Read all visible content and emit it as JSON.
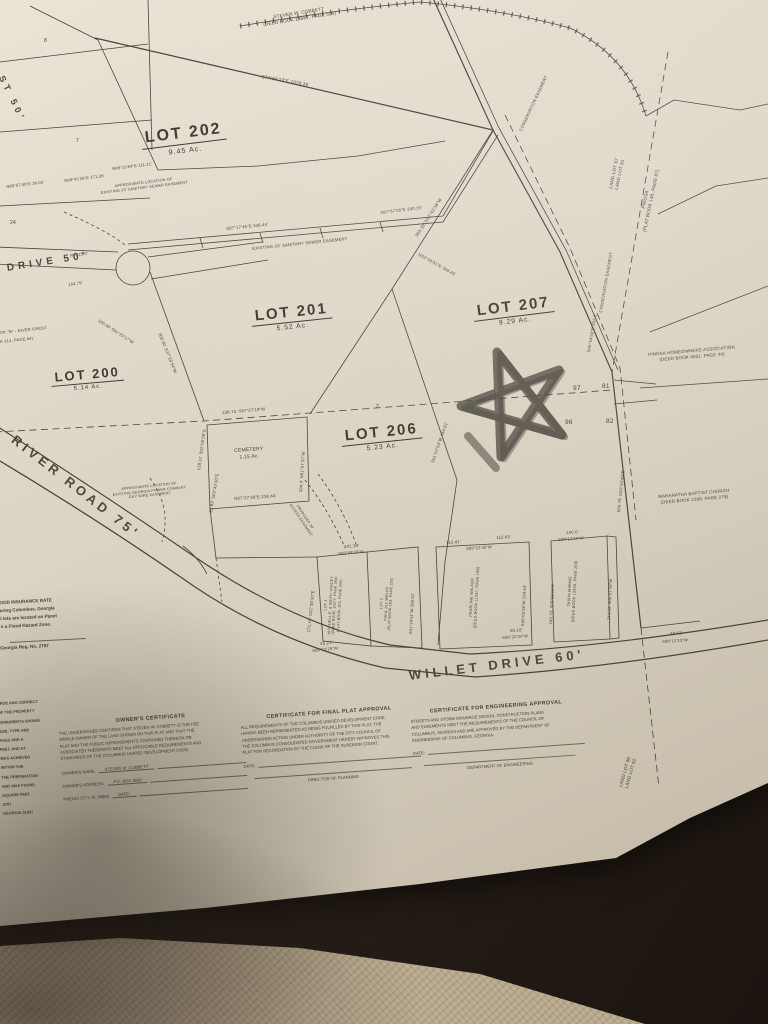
{
  "colors": {
    "paper": "#ded7c8",
    "ink": "#49443c",
    "marker_red": "#c02317",
    "background": "#2a211a",
    "carpet": "#b7a88c"
  },
  "map": {
    "lot_titles": [
      {
        "name": "LOT 202",
        "area": "9.45 Ac.",
        "x": 140,
        "y": 130,
        "r": -7,
        "s": 16
      },
      {
        "name": "LOT 201",
        "area": "5.52 Ac.",
        "x": 250,
        "y": 308,
        "r": -6,
        "s": 15
      },
      {
        "name": "LOT 207",
        "area": "9.29 Ac.",
        "x": 472,
        "y": 303,
        "r": -7,
        "s": 15
      },
      {
        "name": "LOT 200",
        "area": "5.14 Ac.",
        "x": 50,
        "y": 370,
        "r": -5,
        "s": 13
      },
      {
        "name": "LOT 206",
        "area": "5.23 Ac.",
        "x": 340,
        "y": 428,
        "r": -6,
        "s": 15
      }
    ],
    "labels": [
      {
        "t": "STEVEN W. COBBETT\n(DEED BOOK 13867, PAGE 500)",
        "x": 262,
        "y": 16,
        "r": -9,
        "s": 4.6,
        "c": "c"
      },
      {
        "t": "S74°54'13\"E   1078.36'",
        "x": 262,
        "y": 74,
        "r": 10,
        "s": 4.6
      },
      {
        "t": "365.36'  S32°42'38\"W",
        "x": 414,
        "y": 235,
        "r": -57,
        "s": 4.4
      },
      {
        "t": "CONSERVATION EASEMENT",
        "x": 518,
        "y": 130,
        "r": -65,
        "s": 4.2
      },
      {
        "t": "CONSERVATION EASEMENT",
        "x": 598,
        "y": 312,
        "r": -80,
        "s": 4.2
      },
      {
        "t": "LAND LOT 97\nLAND LOT 81",
        "x": 608,
        "y": 188,
        "r": -78,
        "s": 4.6,
        "c": "c"
      },
      {
        "t": "PINOSA\n(PLAT BOOK 148, PAGE 87)",
        "x": 636,
        "y": 230,
        "r": -78,
        "s": 4.6,
        "c": "c"
      },
      {
        "t": "PINOSA HOMEOWNERS ASSOCIATION\n(DEED BOOK 6051, PAGE 44)",
        "x": 648,
        "y": 352,
        "r": -5,
        "s": 4.4,
        "c": "c"
      },
      {
        "t": "MARANATHA BAPTIST CHURCH\n(DEED BOOK 2368, PAGE 279)",
        "x": 658,
        "y": 494,
        "r": -5,
        "s": 4.4,
        "c": "c"
      },
      {
        "t": "97",
        "x": 573,
        "y": 385,
        "r": 0,
        "s": 6.5
      },
      {
        "t": "81",
        "x": 602,
        "y": 383,
        "r": 0,
        "s": 6.5
      },
      {
        "t": "96",
        "x": 565,
        "y": 419,
        "r": 0,
        "s": 6.5
      },
      {
        "t": "82",
        "x": 606,
        "y": 418,
        "r": 0,
        "s": 6.5
      },
      {
        "t": "EXISTING 20' SANITARY SEWER EASEMENT",
        "x": 252,
        "y": 246,
        "r": -6,
        "s": 4.2
      },
      {
        "t": "APPROXIMATE LOCATION OF\nEXISTING 20' SANITARY SEWER EASEMENT",
        "x": 100,
        "y": 186,
        "r": -7,
        "s": 3.8,
        "c": "c"
      },
      {
        "t": "S87°17'45\"E   338.44'",
        "x": 226,
        "y": 226,
        "r": -6,
        "s": 4.2
      },
      {
        "t": "S87°57'25\"E   290.15'",
        "x": 380,
        "y": 210,
        "r": -7,
        "s": 4.2
      },
      {
        "t": "N03°28'51\"E  358.45'",
        "x": 420,
        "y": 252,
        "r": 29,
        "s": 4.2
      },
      {
        "t": "CEMETERY\n1.15 Ac.",
        "x": 234,
        "y": 448,
        "r": -4,
        "s": 5,
        "c": "c"
      },
      {
        "t": "238.75'  S87°27'19\"W",
        "x": 222,
        "y": 410,
        "r": -5,
        "s": 4.2
      },
      {
        "t": "128.11'  S02°00'26\"E",
        "x": 196,
        "y": 470,
        "r": -82,
        "s": 4.2
      },
      {
        "t": "82.82'  S03°43'30\"E",
        "x": 208,
        "y": 512,
        "r": -80,
        "s": 4.2
      },
      {
        "t": "N87°27'26\"E   238.44'",
        "x": 234,
        "y": 496,
        "r": -4,
        "s": 4.2
      },
      {
        "t": "204.4'  N01°57'37\"W",
        "x": 298,
        "y": 492,
        "r": -86,
        "s": 4.2
      },
      {
        "t": "S00°44'50\"E  302.6'",
        "x": 586,
        "y": 352,
        "r": -80,
        "s": 4.2
      },
      {
        "t": "600.78'  S00°43'49\"E",
        "x": 616,
        "y": 512,
        "r": -84,
        "s": 4.2
      },
      {
        "t": "RIVER  ROAD   75'",
        "x": 18,
        "y": 432,
        "r": 38,
        "s": 13,
        "c": "road"
      },
      {
        "t": "WILLET  DRIVE   60'",
        "x": 408,
        "y": 668,
        "r": -7,
        "s": 13,
        "c": "road"
      },
      {
        "t": "DRIVE  50'",
        "x": 6,
        "y": 262,
        "r": -9,
        "s": 10,
        "c": "road"
      },
      {
        "t": "ST  50'",
        "x": 6,
        "y": 74,
        "r": 64,
        "s": 9,
        "c": "road"
      },
      {
        "t": "N89°43'26\"E   171.28'",
        "x": 64,
        "y": 178,
        "r": -7,
        "s": 4
      },
      {
        "t": "N89°13'54\"E   111.21'",
        "x": 112,
        "y": 166,
        "r": -7,
        "s": 4
      },
      {
        "t": "N89°57'40\"E  30.02'",
        "x": 6,
        "y": 184,
        "r": -7,
        "s": 4
      },
      {
        "t": "309.30'  S37°38'34\"W",
        "x": 162,
        "y": 332,
        "r": 68,
        "s": 4.2
      },
      {
        "t": "S01°07'54\"W  444.61'",
        "x": 430,
        "y": 462,
        "r": -71,
        "s": 4.2
      },
      {
        "t": "171.15'  S02°36'30\"E",
        "x": 306,
        "y": 632,
        "r": -84,
        "s": 4.2
      },
      {
        "t": "241.39'",
        "x": 344,
        "y": 544,
        "r": -5,
        "s": 4.2
      },
      {
        "t": "S89°59'23\"W",
        "x": 338,
        "y": 551,
        "r": -5,
        "s": 4
      },
      {
        "t": "LOT 1\nMITCHELL E. & SMITH YANCEY\n(DEED BOOK 11177, PAGE 284)\n(PLAT BOOK 163, PAGE 293)",
        "x": 322,
        "y": 634,
        "r": -87,
        "s": 3.6,
        "c": "c"
      },
      {
        "t": "LOT 2\nTIM & JILL WELCH\n(PLAT BOOK 163, PAGE 250)",
        "x": 378,
        "y": 630,
        "r": -87,
        "s": 3.6,
        "c": "c"
      },
      {
        "t": "S01°34'51\"W  286.61'",
        "x": 408,
        "y": 634,
        "r": -87,
        "s": 4
      },
      {
        "t": "PEARLINE WALKER\n(DEED BOOK 11087, PAGE 199)",
        "x": 468,
        "y": 628,
        "r": -87,
        "s": 3.8,
        "c": "c"
      },
      {
        "t": "S00°05'38\"W  234.64'",
        "x": 520,
        "y": 626,
        "r": -87,
        "s": 4
      },
      {
        "t": "243.75'  S00°08'18\"E",
        "x": 548,
        "y": 624,
        "r": -87,
        "s": 4
      },
      {
        "t": "TASHA MARINE\n(DEED BOOK 12943, PAGE 259)",
        "x": 566,
        "y": 622,
        "r": -87,
        "s": 3.8,
        "c": "c"
      },
      {
        "t": "244.03'  S00°07'39\"W",
        "x": 606,
        "y": 620,
        "r": -87,
        "s": 4
      },
      {
        "t": "112.41'",
        "x": 446,
        "y": 540,
        "r": -4,
        "s": 4.2
      },
      {
        "t": "112.43'",
        "x": 496,
        "y": 535,
        "r": -4,
        "s": 4.2
      },
      {
        "t": "S89°22'36\"W",
        "x": 466,
        "y": 546,
        "r": -4,
        "s": 4
      },
      {
        "t": "140.0'",
        "x": 566,
        "y": 530,
        "r": -4,
        "s": 4.2
      },
      {
        "t": "S89°17'10\"W",
        "x": 558,
        "y": 537,
        "r": -4,
        "s": 4
      },
      {
        "t": "80.18'",
        "x": 510,
        "y": 628,
        "r": -4,
        "s": 4.2
      },
      {
        "t": "S89°20'34\"W",
        "x": 502,
        "y": 635,
        "r": -4,
        "s": 4
      },
      {
        "t": "45.21'",
        "x": 320,
        "y": 641,
        "r": -6,
        "s": 4.2
      },
      {
        "t": "S89°23'29\"W",
        "x": 312,
        "y": 648,
        "r": -6,
        "s": 4
      },
      {
        "t": "49.52'",
        "x": 670,
        "y": 631,
        "r": -4,
        "s": 4.2
      },
      {
        "t": "S89°12'13\"W",
        "x": 662,
        "y": 639,
        "r": -4,
        "s": 4
      },
      {
        "t": "LAND LOT 96\nLAND LOT 82",
        "x": 618,
        "y": 786,
        "r": -74,
        "s": 4.6,
        "c": "c"
      },
      {
        "t": "APPROXIMATE LOCATION OF\nEXISTING GEORGIA POWER COMPANY\nGUY WIRE EASEMENT",
        "x": 112,
        "y": 488,
        "r": -6,
        "s": 3.6,
        "c": "c"
      },
      {
        "t": "PROPOSED 20'\nACCESS EASEMENT",
        "x": 296,
        "y": 500,
        "r": 56,
        "s": 3.6,
        "c": "c"
      },
      {
        "t": "CK \"B\"  -  RIVER CREST",
        "x": 0,
        "y": 330,
        "r": -6,
        "s": 4
      },
      {
        "t": "K 114, PAGE 64)",
        "x": 0,
        "y": 339,
        "r": -6,
        "s": 4
      },
      {
        "t": "R=225.0'",
        "x": 70,
        "y": 253,
        "r": -8,
        "s": 4
      },
      {
        "t": "154.79'",
        "x": 68,
        "y": 282,
        "r": -8,
        "s": 4
      },
      {
        "t": "100.00'  S01°23'17\"W",
        "x": 100,
        "y": 318,
        "r": 33,
        "s": 4
      },
      {
        "t": "8",
        "x": 44,
        "y": 38,
        "r": 0,
        "s": 5
      },
      {
        "t": "7",
        "x": 76,
        "y": 138,
        "r": 0,
        "s": 5
      },
      {
        "t": "24",
        "x": 10,
        "y": 220,
        "r": 0,
        "s": 5
      },
      {
        "t": "2",
        "x": 376,
        "y": 404,
        "r": 0,
        "s": 5
      }
    ]
  },
  "certificates": {
    "owner": {
      "title": "OWNER'S CERTIFICATE",
      "body": "THE UNDERSIGNED CERTIFIES THAT STEVEN W. COBBETT IS THE FEE\nSIMPLE OWNER OF THE LAND SHOWN ON THIS PLAT AND THAT THE\nPLAT AND THE PUBLIC IMPROVEMENTS CONTAINED THEREON OR\nASSOCIATED THEREWITH MEET ALL APPLICABLE REQUIREMENTS AND\nSTANDARDS OF THE COLUMBUS UNIFIED DEVELOPMENT CODE.",
      "fields": [
        {
          "label": "OWNER'S NAME:",
          "value": "STEVEN W. COBBETT"
        },
        {
          "label": "OWNER'S ADDRESS:",
          "value": "P.O. BOX 3690"
        },
        {
          "label": "PHENIX CITY, AL 36868",
          "value": "DATE:"
        }
      ]
    },
    "final_plat": {
      "title": "CERTIFICATE FOR FINAL PLAT APPROVAL",
      "body": "ALL REQUIREMENTS OF THE COLUMBUS UNIFIED DEVELOPMENT CODE,\nHAVING BEEN REPRESENTED AS BEING FULFILLED BY THIS PLAT, THE\nUNDERSIGNED ACTING UNDER AUTHORITY OF THE CITY COUNCIL OF\nTHE COLUMBUS CONSOLIDATED GOVERNMENT HEREBY APPROVES THIS\nPLAT FOR RECORDATION BY THE CLERK OF THE SUPERIOR COURT.",
      "date_label": "DATE:",
      "signature_label": "DIRECTOR OF PLANNING"
    },
    "engineering": {
      "title": "CERTIFICATE FOR ENGINEERING APPROVAL",
      "body": "STREETS AND STORM DRAINAGE DESIGN, CONSTRUCTION PLANS\nAND EASEMENTS MEET THE REQUIREMENTS OF THE COUNCIL OF\nCOLUMBUS, GEORGIA AND ARE APPROVED BY THE DEPARTMENT OF\nENGINEERING OF COLUMBUS, GEORGIA.",
      "date_label": "DATE:",
      "signature_label": "DEPARTMENT OF ENGINEERING"
    }
  },
  "notes": {
    "flood_lines": [
      "OOD INSURANCE RATE",
      "ering Columbus, Georgia",
      "l lots are located on Panel",
      "n a Flood Hazard Zone."
    ],
    "reg_line": "Georgia Reg. No. 2787",
    "fragments": [
      "E",
      "TRUE AND CORRECT",
      "OF THE PROPERTY",
      "MONUMENTS SHOWN",
      "SIZE, TYPE AND",
      "AGES AND A",
      "FEET, AND AT",
      "WAS ACHIEVED",
      "WITHIN THE",
      "THE PREPARATION",
      "AND WAS FOUND",
      "SQUARE FEET.",
      "2787",
      "GEORGIA 31907"
    ]
  }
}
